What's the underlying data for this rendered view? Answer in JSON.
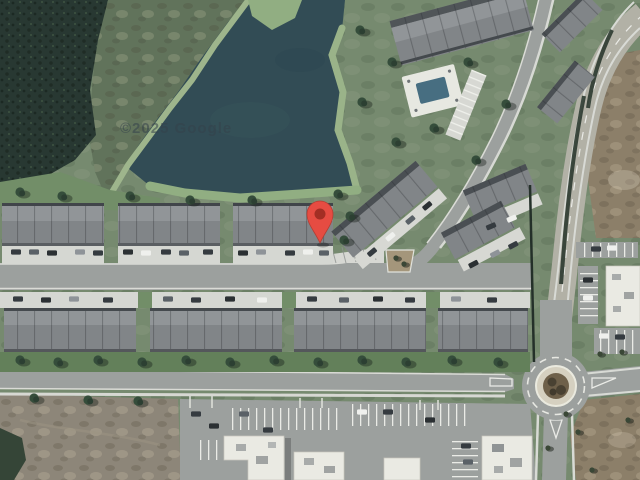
{
  "map": {
    "view_type": "satellite-imagery",
    "attribution": "©2025 Google",
    "marker": {
      "name": "dropped-pin",
      "tip_x": 320,
      "tip_y": 243
    },
    "features": {
      "pond": "retention-pond",
      "marsh": "wetland-thicket",
      "townhouse_rows": "3-rows-of-townhomes",
      "roundabout": "four-way-roundabout",
      "pool": "community-pool",
      "commercial": "retail-buildings-with-parking"
    }
  },
  "colors": {
    "marker_body": "#E8453A",
    "marker_dot": "#A2251B",
    "water": "#2B454E",
    "marsh": "#20302A",
    "grass": "#72866A",
    "bank": "#9CB488",
    "lawn": "#5E7C54",
    "road": "#9A9D9B",
    "arterial": "#B2AFA4",
    "concrete": "#D6D7D2",
    "roof": "#7E8184",
    "roof_light": "#8F9295",
    "commercial_roof": "#EDEBE4",
    "field_brown": "#8A7B64",
    "field_gray": "#8B8274",
    "apron": "#D6D0BF",
    "island_brown": "#6A5A43",
    "tree": "#2E4633",
    "attribution_color": "rgba(45,58,68,0.55)"
  }
}
